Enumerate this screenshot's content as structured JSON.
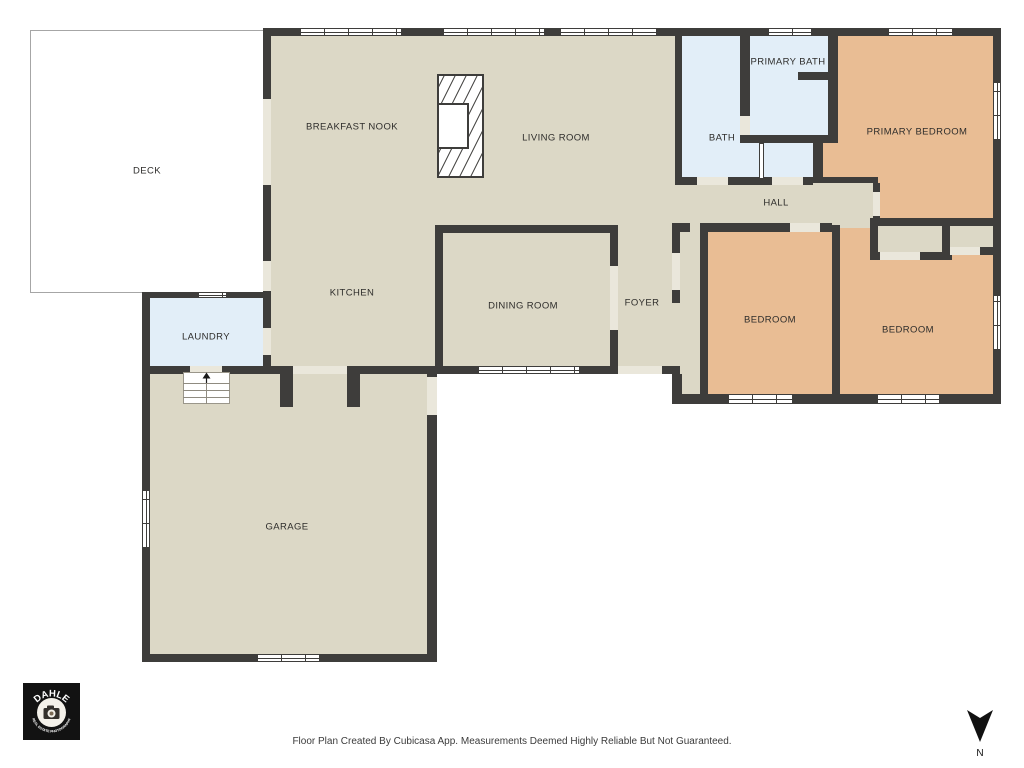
{
  "floorplan": {
    "colors": {
      "wall": "#3e3d3b",
      "floor": "#dcd8c6",
      "bedroom_floor": "#e9bd94",
      "bath_floor": "#e2eef8",
      "deck": "#ffffff",
      "door_opening": "#eae7db"
    },
    "rooms": [
      {
        "id": "deck",
        "label": "DECK"
      },
      {
        "id": "breakfast-nook",
        "label": "BREAKFAST NOOK"
      },
      {
        "id": "living-room",
        "label": "LIVING ROOM"
      },
      {
        "id": "kitchen",
        "label": "KITCHEN"
      },
      {
        "id": "dining-room",
        "label": "DINING ROOM"
      },
      {
        "id": "foyer",
        "label": "FOYER"
      },
      {
        "id": "laundry",
        "label": "LAUNDRY"
      },
      {
        "id": "garage",
        "label": "GARAGE"
      },
      {
        "id": "bath",
        "label": "BATH"
      },
      {
        "id": "primary-bath",
        "label": "PRIMARY BATH"
      },
      {
        "id": "primary-bedroom",
        "label": "PRIMARY BEDROOM"
      },
      {
        "id": "hall",
        "label": "HALL"
      },
      {
        "id": "bedroom-1",
        "label": "BEDROOM"
      },
      {
        "id": "bedroom-2",
        "label": "BEDROOM"
      }
    ],
    "logo": {
      "brand": "DAHLE",
      "tagline": "REAL ESTATE PHOTOGRAPHY"
    },
    "compass": {
      "label": "N"
    },
    "footer": {
      "text": "Floor Plan Created By Cubicasa App. Measurements Deemed Highly Reliable But Not Guaranteed."
    }
  }
}
